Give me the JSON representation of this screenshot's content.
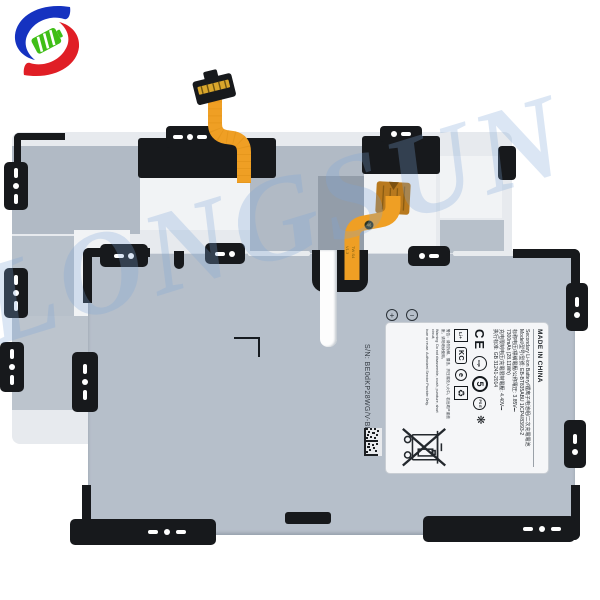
{
  "background": "#ffffff",
  "logo": {
    "name": "battery-brand-swirl-logo",
    "colors": {
      "blue": "#1532c0",
      "red": "#e01e25",
      "green": "#3fbe16"
    }
  },
  "watermark": {
    "text": "LONGSUN",
    "color": "#7ea6d8"
  },
  "front_battery": {
    "serial": "S/N: BE0dKP28WG/V-BLH",
    "polarity": {
      "plus": "+",
      "minus": "−"
    },
    "flex_markings": {
      "circle_badge": "46",
      "line1": "TW S4",
      "line2": "V1.3"
    },
    "label": {
      "made_in": "MADE IN CHINA",
      "spec_lines": [
        "Secondary Li-ion Battery/锂离子电池组/二次充電電池",
        "Model/型号/型號: EB-BT835ABU   1ICP4/83/93-2",
        "标称电压/標稱電壓/公称電圧: 3.85V⎓",
        "7300mAh (28.11Wh)",
        "充电限制电压/充電限制電壓: 4.40V⎓",
        "执行标准: GB 31241-2014"
      ],
      "warning_lines": [
        "警告：请勿拆解、撞击、挤压或投入火中。若出现严重鼓胀，请勿继续使用。",
        "Warning: Do not disassemble, crush, puncture, short circuit,",
        "burn or reuse. Authorized Service Provider Only."
      ],
      "certs": {
        "ce": "CE",
        "cqc": "cqc",
        "recycle5": "5",
        "pse": "PS E",
        "flower": "❋",
        "liion": "Li+",
        "kc": "KC",
        "edot": "e",
        "recycle": "♻"
      }
    }
  }
}
